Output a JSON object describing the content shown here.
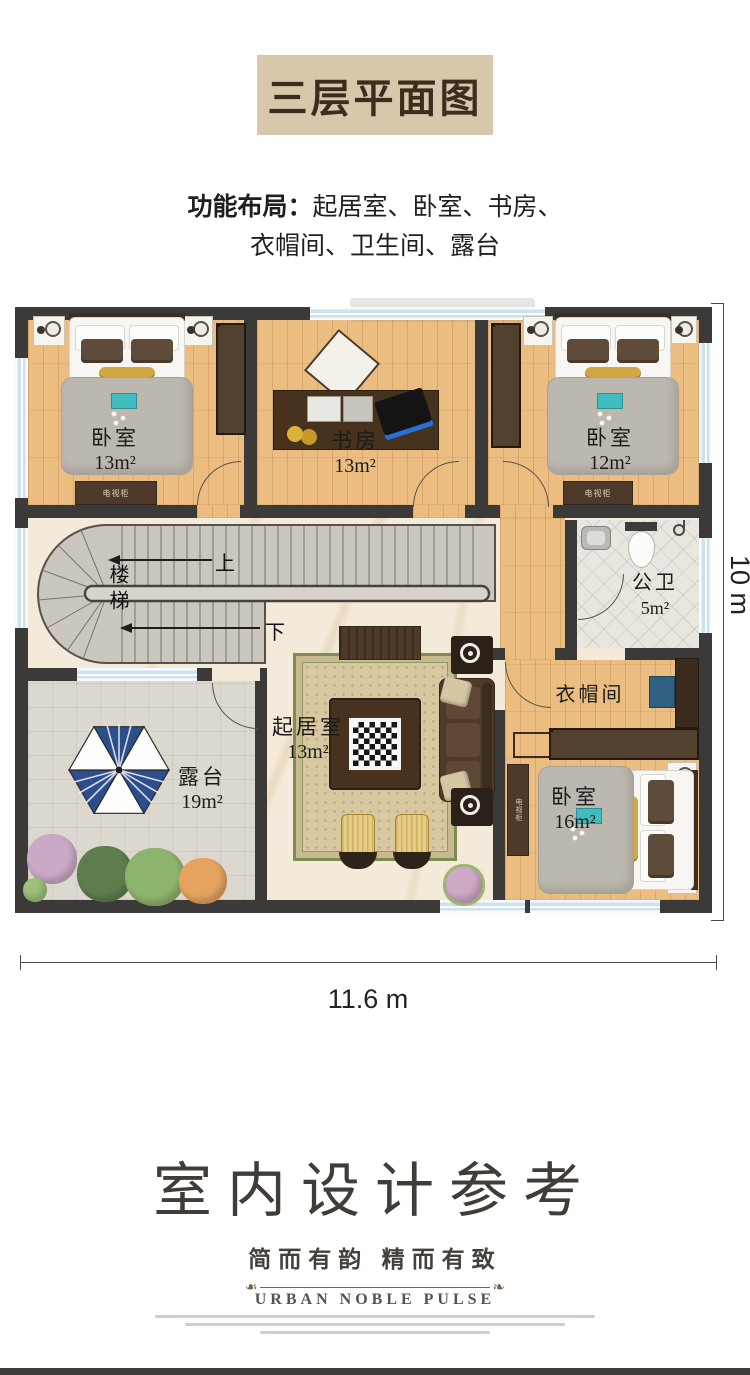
{
  "title": "三层平面图",
  "subtitle": {
    "prefix": "功能布局：",
    "line1": "起居室、卧室、书房、",
    "line2": "衣帽间、卫生间、露台"
  },
  "plan": {
    "rooms": {
      "bedroom_tl": {
        "name": "卧室",
        "area": "13m²"
      },
      "study": {
        "name": "书房",
        "area": "13m²"
      },
      "bedroom_tr": {
        "name": "卧室",
        "area": "12m²"
      },
      "stairs": {
        "name": "楼梯"
      },
      "bath": {
        "name": "公卫",
        "area": "5m²"
      },
      "living": {
        "name": "起居室",
        "area": "13m²"
      },
      "terrace": {
        "name": "露台",
        "area": "19m²"
      },
      "cloakroom": {
        "name": "衣帽间"
      },
      "bedroom_br": {
        "name": "卧室",
        "area": "16m²"
      }
    },
    "annotations": {
      "up": "上",
      "down": "下",
      "tv_cabinet": "电视柜"
    },
    "dimensions": {
      "width": "11.6 m",
      "height": "10 m"
    }
  },
  "footer": {
    "heading": "室内设计参考",
    "tagline": "简而有韵  精而有致",
    "brand": "URBAN NOBLE PULSE"
  },
  "colors": {
    "wall": "#3b3a38",
    "wood_floor": "#ecbd80",
    "marble_floor": "#f4ead9",
    "title_bg": "#d8c8ab",
    "umbrella_blue": "#2d4e8c",
    "window_blue": "#cfe2ea"
  }
}
